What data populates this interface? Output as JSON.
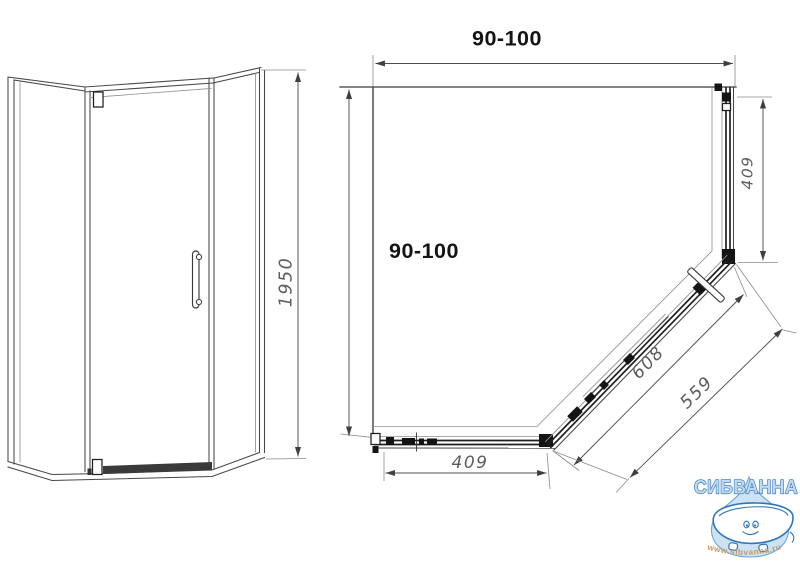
{
  "drawing": {
    "front_view": {
      "height_dim": "1950"
    },
    "plan_view": {
      "width_dim": "90-100",
      "depth_dim": "90-100",
      "side_panel_dim": "409",
      "front_panel_dim": "409",
      "door_glass_dim": "608",
      "door_opening_dim": "559"
    }
  },
  "watermark": {
    "brand": "СИБВАННА",
    "website": "www.sibvanna.ru",
    "colors": {
      "letter_fill": "#bedaf0",
      "letter_outline": "#2e6db4",
      "drop_fill": "#cde3f5",
      "drop_outline": "#66a5d9",
      "tub_outline": "#2e75b6",
      "url_color": "#c8995f"
    }
  }
}
